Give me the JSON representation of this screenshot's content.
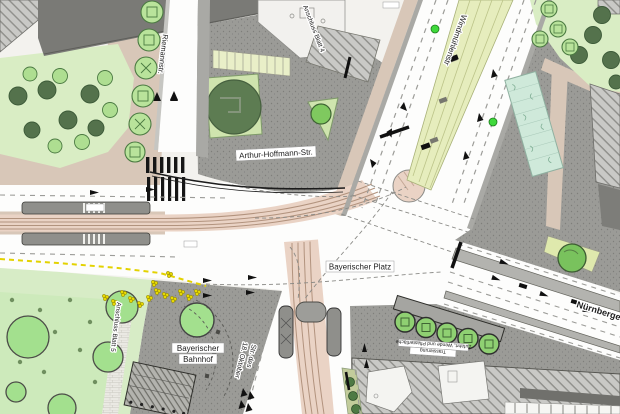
{
  "map": {
    "description": "Verkehrsplan Knotenpunkt Bayerischer Platz (Lageplan)",
    "labels": {
      "riemannstr": "Riemannstr.",
      "arthur_hoffmann": "Arthur-Hoffmann-Str.",
      "windmuehlenstr": "Windmühlenstr",
      "bayerischer_platz": "Bayerischer Platz",
      "nuernberger_str": "Nürnberger S",
      "bahnhof_line1": "Bayerischer",
      "bahnhof_line2": "Bahnhof",
      "str18_line1": "Str. des",
      "str18_line2": "18. Oktober",
      "anschluss_blatt4": "Anschluss Blatt 4",
      "anschluss_blatt5": "Anschluss Blatt 5",
      "annotation_line1": "Trassierung",
      "annotation_line2": "Zufahrt, Wende und Pflasterfläche"
    },
    "colors": {
      "plaza_gray": "#9b9b97",
      "building_hatch": "#c9c9c6",
      "roof_dark": "#7a7a76",
      "park_green": "#d9edc4",
      "lawn_green": "#cdeabb",
      "tree_dark": "#54724c",
      "tree_light": "#a7dd8d",
      "canopy_light": "#9fdf8f",
      "tram_bed_salmon": "#ead3c5",
      "tram_median_green": "#e6edbd",
      "planter_teal": "#cfe9da",
      "sidewalk_tan": "#d8c7b8",
      "road_white": "#ffffff",
      "marking_yellow": "#e8d900",
      "signal_green": "#3fd93b"
    }
  }
}
